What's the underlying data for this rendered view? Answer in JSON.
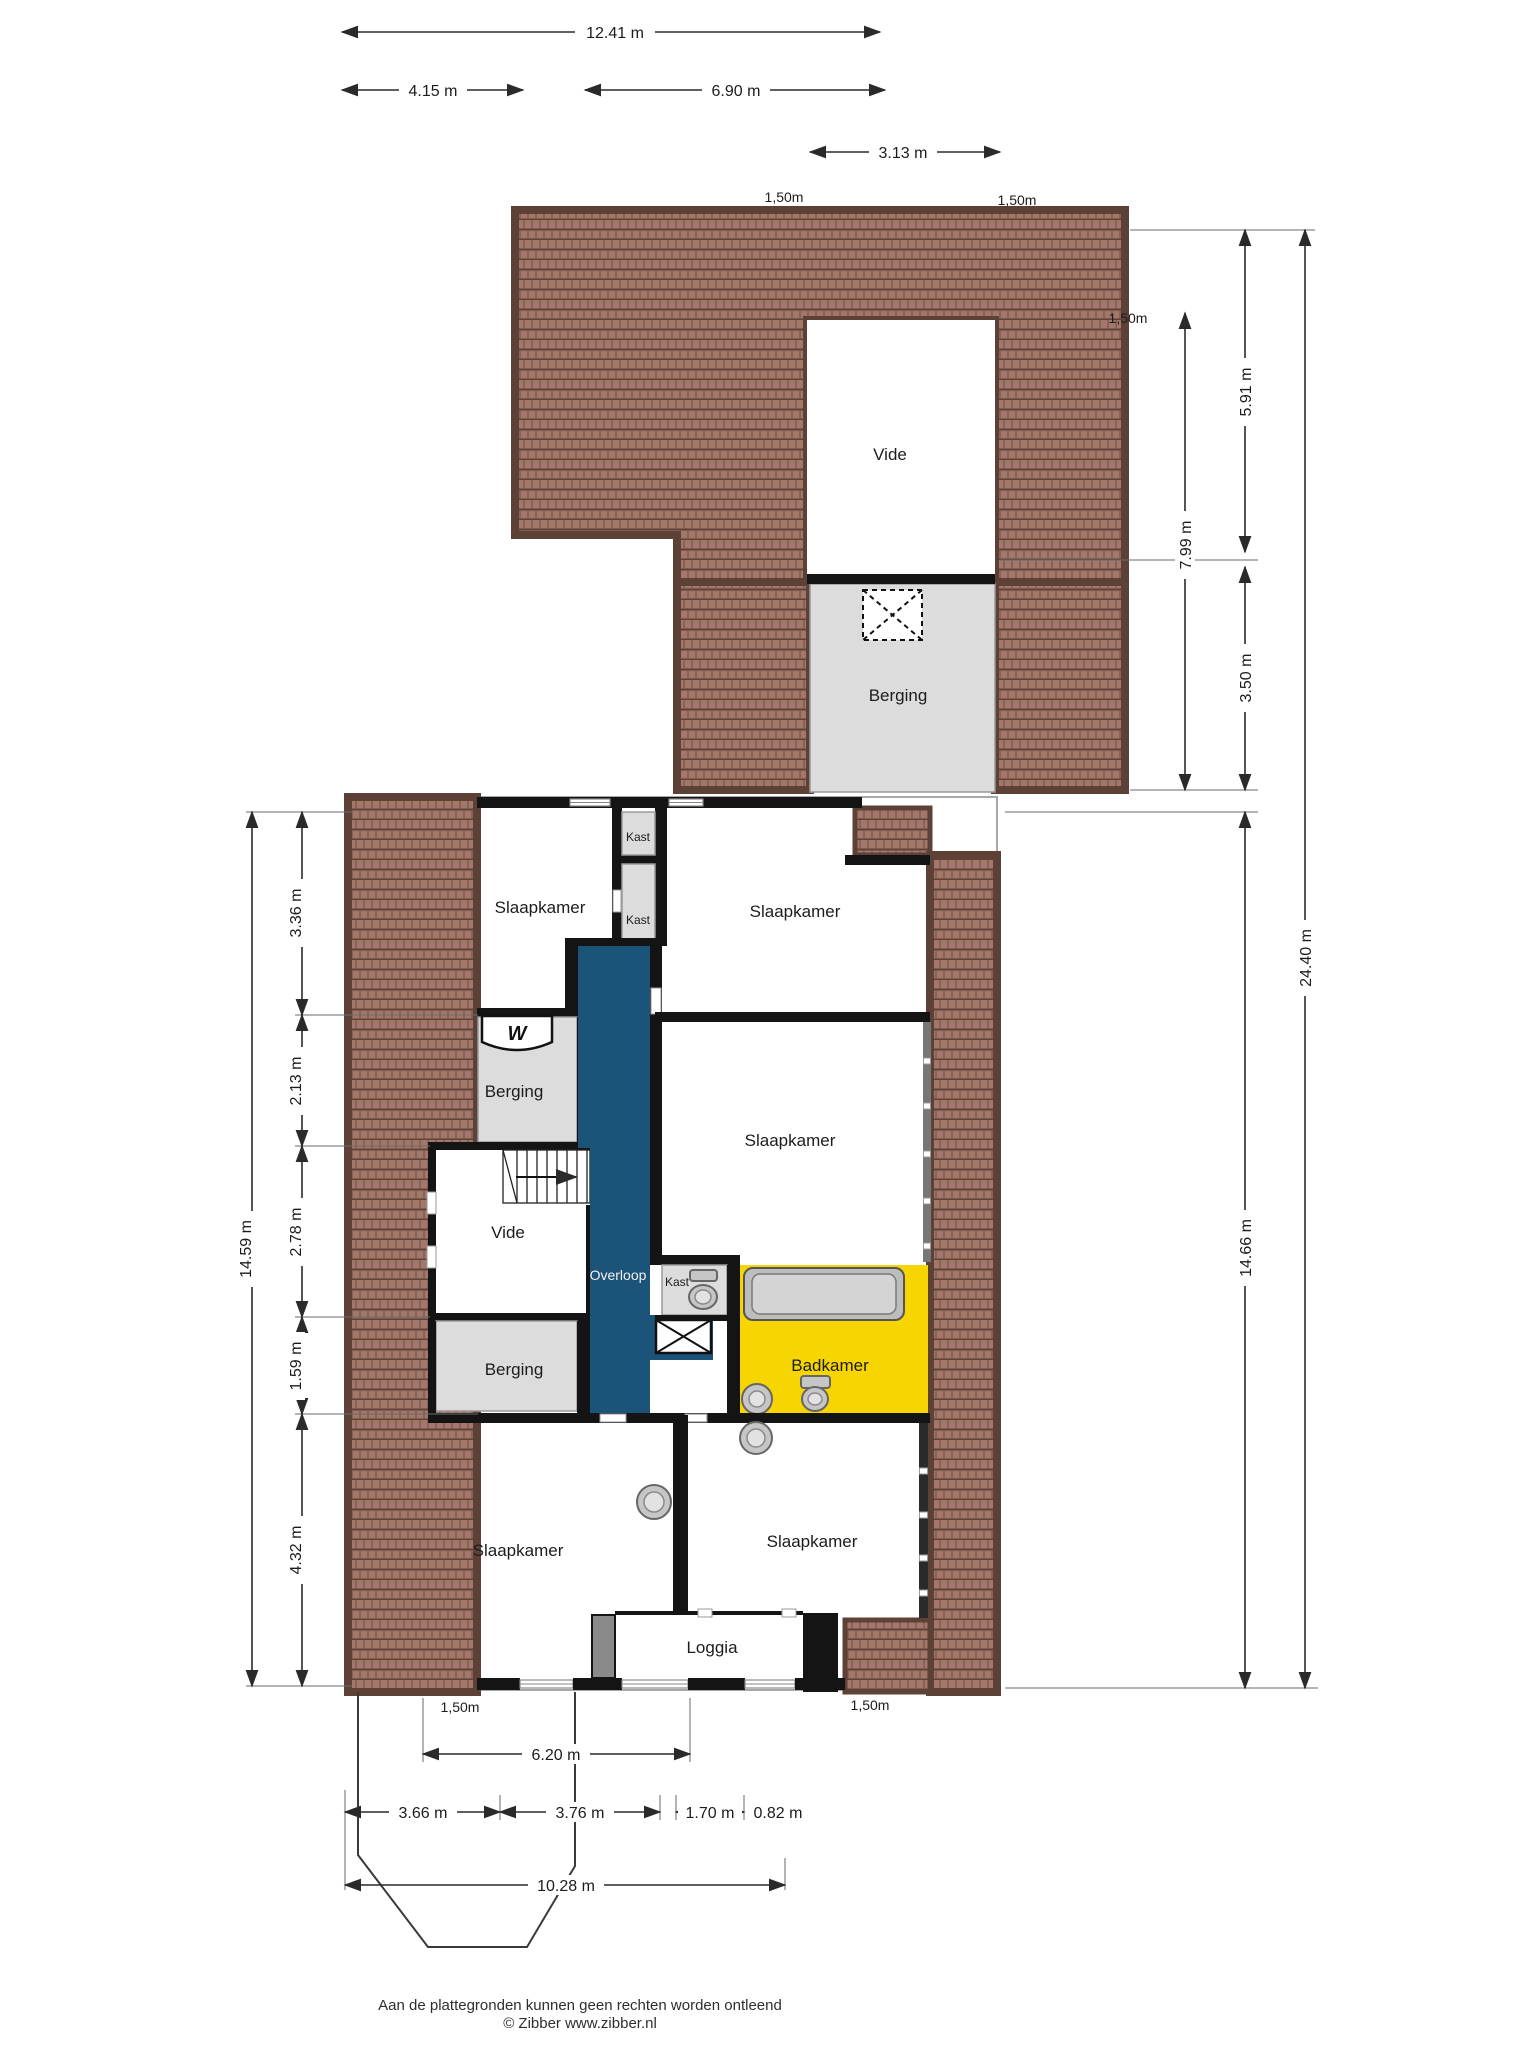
{
  "plan": {
    "title_note": "floor plan sheet",
    "rooms": {
      "vide_top": "Vide",
      "berging_top": "Berging",
      "slaapkamer_nw": "Slaapkamer",
      "kast_a": "Kast",
      "kast_b": "Kast",
      "slaapkamer_ne": "Slaapkamer",
      "berging_west": "Berging",
      "slaapkamer_east": "Slaapkamer",
      "vide_west": "Vide",
      "overloop": "Overloop",
      "kast_c": "Kast",
      "badkamer": "Badkamer",
      "berging_southwest": "Berging",
      "slaapkamer_sw": "Slaapkamer",
      "slaapkamer_se": "Slaapkamer",
      "loggia": "Loggia"
    },
    "dimensions": {
      "top": {
        "total": "12.41 m",
        "left": "4.15 m",
        "right": "6.90 m",
        "vide": "3.13 m",
        "eave_left": "1,50m",
        "eave_right": "1,50m"
      },
      "right": {
        "eave": "1,50m",
        "upper": "5.91 m",
        "inner": "7.99 m",
        "lower": "3.50 m",
        "building": "14.66 m",
        "total": "24.40 m"
      },
      "left": {
        "seg1": "3.36 m",
        "seg2": "2.13 m",
        "seg3": "2.78 m",
        "seg4": "1.59 m",
        "seg5": "4.32 m",
        "total": "14.59 m"
      },
      "bottom": {
        "eave_left": "1,50m",
        "eave_right": "1,50m",
        "row1": "6.20 m",
        "row2a": "3.66 m",
        "row2b": "3.76 m",
        "row2c": "1.70 m",
        "row2d": "0.82 m",
        "row3": "10.28 m"
      }
    },
    "footer": {
      "line1": "Aan de plattegronden kunnen geen rechten worden ontleend",
      "line2": "© Zibber www.zibber.nl"
    },
    "colors": {
      "roof_base": "#a37769",
      "roof_dark": "#5d4136",
      "room_gray": "#dcdcdc",
      "hall_blue": "#1b5379",
      "bath_yellow": "#f6d500",
      "fixture_gray": "#c6c6c6",
      "wall": "#141414"
    }
  }
}
